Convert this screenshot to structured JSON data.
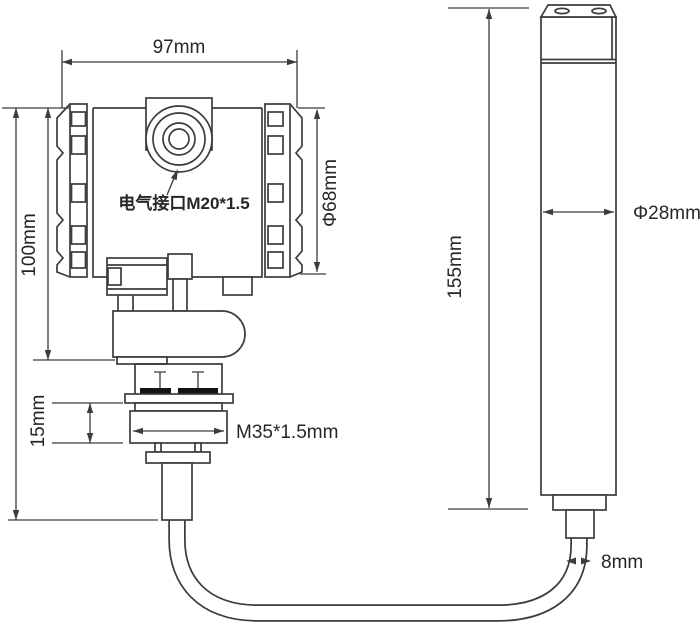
{
  "drawing": {
    "type": "technical-dimension-drawing",
    "subject": "pressure transmitter with submersible level probe",
    "colors": {
      "line": "#3c3c3c",
      "text": "#262626",
      "background": "#ffffff",
      "washer_fill": "#141414"
    },
    "labels": {
      "top_width": "97mm",
      "body_height": "100mm",
      "electrical_port": "电气接口M20*1.5",
      "body_diameter": "Φ68mm",
      "flange_height": "15mm",
      "thread_spec": "M35*1.5mm",
      "probe_height": "155mm",
      "probe_diameter": "Φ28mm",
      "cable_diameter": "8mm"
    }
  }
}
